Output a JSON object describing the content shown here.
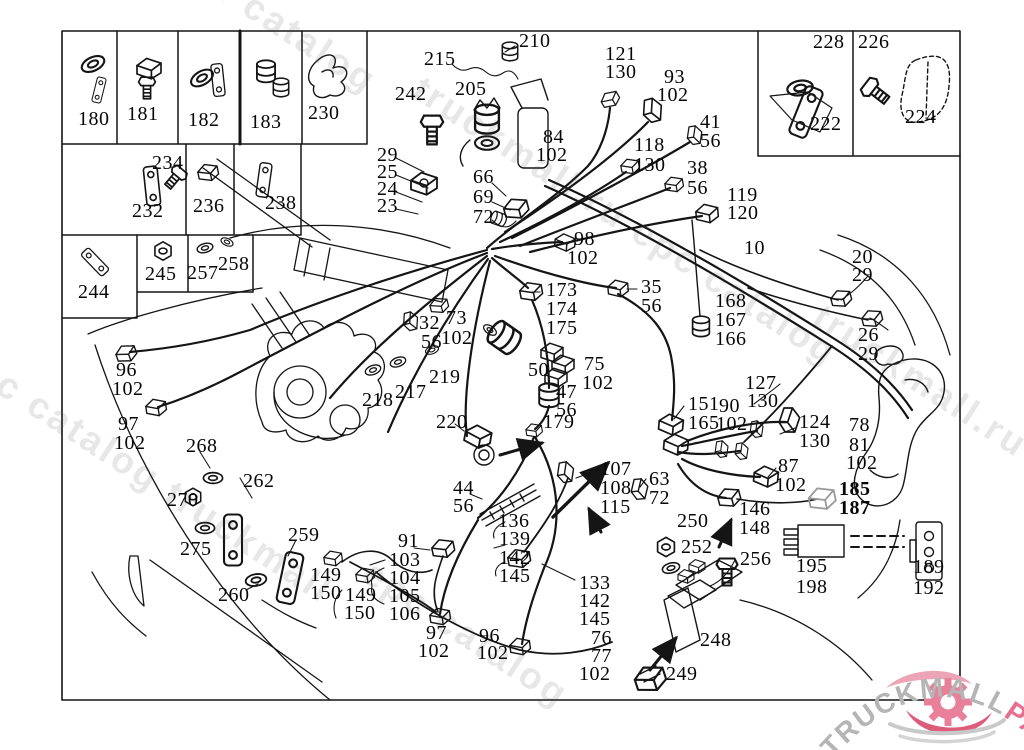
{
  "doc": {
    "type": "wiring-harness parts diagram",
    "main_harness_ref": "10",
    "line_color": "#151515",
    "background": "#ffffff"
  },
  "logo": {
    "grey_text": "TRUCKMALL",
    "pink_text": "PARTS",
    "grey_color": "#b5b5b5",
    "pink_color": "#e86e90"
  },
  "watermarks": [
    {
      "text": "epc catalog",
      "x": 186,
      "y": -62
    },
    {
      "text": "truckmall.ru epc catalog",
      "x": 428,
      "y": 68
    },
    {
      "text": "l epc catalog truckmall",
      "x": -52,
      "y": 322
    },
    {
      "text": "truckmall.ru e",
      "x": 828,
      "y": 296
    },
    {
      "text": "epc catalog",
      "x": 378,
      "y": 552
    }
  ],
  "part_labels": [
    {
      "t": "180",
      "x": 78,
      "y": 109
    },
    {
      "t": "181",
      "x": 127,
      "y": 104
    },
    {
      "t": "182",
      "x": 188,
      "y": 110
    },
    {
      "t": "183",
      "x": 250,
      "y": 112
    },
    {
      "t": "230",
      "x": 308,
      "y": 103
    },
    {
      "t": "234",
      "x": 152,
      "y": 153
    },
    {
      "t": "232",
      "x": 132,
      "y": 201
    },
    {
      "t": "236",
      "x": 193,
      "y": 196
    },
    {
      "t": "238",
      "x": 265,
      "y": 193
    },
    {
      "t": "244",
      "x": 78,
      "y": 282
    },
    {
      "t": "245",
      "x": 145,
      "y": 264
    },
    {
      "t": "257",
      "x": 187,
      "y": 263
    },
    {
      "t": "258",
      "x": 218,
      "y": 254
    },
    {
      "t": "228",
      "x": 813,
      "y": 32
    },
    {
      "t": "222",
      "x": 810,
      "y": 114
    },
    {
      "t": "226",
      "x": 858,
      "y": 32
    },
    {
      "t": "224",
      "x": 905,
      "y": 107
    },
    {
      "t": "242",
      "x": 395,
      "y": 84
    },
    {
      "t": "215",
      "x": 424,
      "y": 49
    },
    {
      "t": "210",
      "x": 519,
      "y": 31
    },
    {
      "t": "205",
      "x": 455,
      "y": 79
    },
    {
      "t": "121",
      "x": 605,
      "y": 44
    },
    {
      "t": "130",
      "x": 605,
      "y": 62
    },
    {
      "t": "93",
      "x": 664,
      "y": 67
    },
    {
      "t": "102",
      "x": 657,
      "y": 85
    },
    {
      "t": "84",
      "x": 543,
      "y": 127
    },
    {
      "t": "102",
      "x": 536,
      "y": 145
    },
    {
      "t": "41",
      "x": 700,
      "y": 112
    },
    {
      "t": "56",
      "x": 700,
      "y": 131
    },
    {
      "t": "118",
      "x": 634,
      "y": 135
    },
    {
      "t": "130",
      "x": 634,
      "y": 155
    },
    {
      "t": "38",
      "x": 687,
      "y": 158
    },
    {
      "t": "56",
      "x": 687,
      "y": 178
    },
    {
      "t": "119",
      "x": 727,
      "y": 185
    },
    {
      "t": "120",
      "x": 727,
      "y": 203
    },
    {
      "t": "29",
      "x": 377,
      "y": 145
    },
    {
      "t": "25",
      "x": 377,
      "y": 162
    },
    {
      "t": "24",
      "x": 377,
      "y": 179
    },
    {
      "t": "23",
      "x": 377,
      "y": 196
    },
    {
      "t": "66",
      "x": 473,
      "y": 167
    },
    {
      "t": "69",
      "x": 473,
      "y": 187
    },
    {
      "t": "72",
      "x": 473,
      "y": 207
    },
    {
      "t": "98",
      "x": 574,
      "y": 229
    },
    {
      "t": "102",
      "x": 567,
      "y": 248
    },
    {
      "t": "10",
      "x": 744,
      "y": 238
    },
    {
      "t": "20",
      "x": 852,
      "y": 247
    },
    {
      "t": "29",
      "x": 852,
      "y": 265
    },
    {
      "t": "173",
      "x": 546,
      "y": 280
    },
    {
      "t": "174",
      "x": 546,
      "y": 299
    },
    {
      "t": "175",
      "x": 546,
      "y": 318
    },
    {
      "t": "35",
      "x": 641,
      "y": 277
    },
    {
      "t": "56",
      "x": 641,
      "y": 296
    },
    {
      "t": "168",
      "x": 715,
      "y": 291
    },
    {
      "t": "167",
      "x": 715,
      "y": 310
    },
    {
      "t": "166",
      "x": 715,
      "y": 329
    },
    {
      "t": "26",
      "x": 858,
      "y": 325
    },
    {
      "t": "29",
      "x": 858,
      "y": 344
    },
    {
      "t": "32",
      "x": 419,
      "y": 313
    },
    {
      "t": "56",
      "x": 421,
      "y": 332
    },
    {
      "t": "73",
      "x": 446,
      "y": 308
    },
    {
      "t": "102",
      "x": 441,
      "y": 328
    },
    {
      "t": "219",
      "x": 429,
      "y": 367
    },
    {
      "t": "218",
      "x": 362,
      "y": 390
    },
    {
      "t": "217",
      "x": 395,
      "y": 382
    },
    {
      "t": "50",
      "x": 528,
      "y": 360
    },
    {
      "t": "75",
      "x": 584,
      "y": 354
    },
    {
      "t": "102",
      "x": 582,
      "y": 373
    },
    {
      "t": "47",
      "x": 556,
      "y": 382
    },
    {
      "t": "56",
      "x": 556,
      "y": 400
    },
    {
      "t": "179",
      "x": 543,
      "y": 412
    },
    {
      "t": "220",
      "x": 436,
      "y": 412
    },
    {
      "t": "96",
      "x": 116,
      "y": 360
    },
    {
      "t": "102",
      "x": 112,
      "y": 379
    },
    {
      "t": "97",
      "x": 118,
      "y": 414
    },
    {
      "t": "102",
      "x": 114,
      "y": 433
    },
    {
      "t": "268",
      "x": 186,
      "y": 436
    },
    {
      "t": "127",
      "x": 745,
      "y": 373
    },
    {
      "t": "130",
      "x": 747,
      "y": 391
    },
    {
      "t": "151",
      "x": 688,
      "y": 394
    },
    {
      "t": "165",
      "x": 688,
      "y": 413
    },
    {
      "t": "90",
      "x": 719,
      "y": 396
    },
    {
      "t": "102",
      "x": 716,
      "y": 414
    },
    {
      "t": "124",
      "x": 799,
      "y": 412
    },
    {
      "t": "130",
      "x": 799,
      "y": 431
    },
    {
      "t": "78",
      "x": 849,
      "y": 415
    },
    {
      "t": "81",
      "x": 849,
      "y": 435
    },
    {
      "t": "102",
      "x": 846,
      "y": 453
    },
    {
      "t": "87",
      "x": 778,
      "y": 456
    },
    {
      "t": "102",
      "x": 775,
      "y": 475
    },
    {
      "t": "185",
      "x": 839,
      "y": 479,
      "b": 1
    },
    {
      "t": "187",
      "x": 839,
      "y": 498,
      "b": 1
    },
    {
      "t": "107",
      "x": 600,
      "y": 459
    },
    {
      "t": "108",
      "x": 600,
      "y": 478
    },
    {
      "t": "115",
      "x": 600,
      "y": 497
    },
    {
      "t": "63",
      "x": 649,
      "y": 469
    },
    {
      "t": "72",
      "x": 649,
      "y": 488
    },
    {
      "t": "146",
      "x": 739,
      "y": 499
    },
    {
      "t": "148",
      "x": 739,
      "y": 518
    },
    {
      "t": "250",
      "x": 677,
      "y": 511
    },
    {
      "t": "252",
      "x": 681,
      "y": 537
    },
    {
      "t": "256",
      "x": 740,
      "y": 549
    },
    {
      "t": "248",
      "x": 700,
      "y": 630
    },
    {
      "t": "249",
      "x": 666,
      "y": 664
    },
    {
      "t": "195",
      "x": 796,
      "y": 556
    },
    {
      "t": "198",
      "x": 796,
      "y": 577
    },
    {
      "t": "189",
      "x": 913,
      "y": 557
    },
    {
      "t": "192",
      "x": 913,
      "y": 578
    },
    {
      "t": "44",
      "x": 453,
      "y": 478
    },
    {
      "t": "56",
      "x": 453,
      "y": 496
    },
    {
      "t": "136",
      "x": 498,
      "y": 511
    },
    {
      "t": "139",
      "x": 499,
      "y": 529
    },
    {
      "t": "142",
      "x": 499,
      "y": 548
    },
    {
      "t": "145",
      "x": 499,
      "y": 566
    },
    {
      "t": "133",
      "x": 579,
      "y": 573
    },
    {
      "t": "142",
      "x": 579,
      "y": 591
    },
    {
      "t": "145",
      "x": 579,
      "y": 609
    },
    {
      "t": "76",
      "x": 591,
      "y": 628
    },
    {
      "t": "77",
      "x": 591,
      "y": 646
    },
    {
      "t": "102",
      "x": 579,
      "y": 664
    },
    {
      "t": "97",
      "x": 426,
      "y": 623
    },
    {
      "t": "102",
      "x": 418,
      "y": 641
    },
    {
      "t": "96",
      "x": 479,
      "y": 626
    },
    {
      "t": "102",
      "x": 477,
      "y": 643
    },
    {
      "t": "91",
      "x": 398,
      "y": 531
    },
    {
      "t": "103",
      "x": 389,
      "y": 550
    },
    {
      "t": "104",
      "x": 389,
      "y": 568
    },
    {
      "t": "105",
      "x": 389,
      "y": 586
    },
    {
      "t": "106",
      "x": 389,
      "y": 604
    },
    {
      "t": "149",
      "x": 310,
      "y": 565
    },
    {
      "t": "150",
      "x": 310,
      "y": 583
    },
    {
      "t": "149",
      "x": 345,
      "y": 585
    },
    {
      "t": "150",
      "x": 344,
      "y": 603
    },
    {
      "t": "259",
      "x": 288,
      "y": 525
    },
    {
      "t": "260",
      "x": 218,
      "y": 585
    },
    {
      "t": "270",
      "x": 167,
      "y": 490
    },
    {
      "t": "275",
      "x": 180,
      "y": 539
    },
    {
      "t": "262",
      "x": 243,
      "y": 471
    }
  ]
}
